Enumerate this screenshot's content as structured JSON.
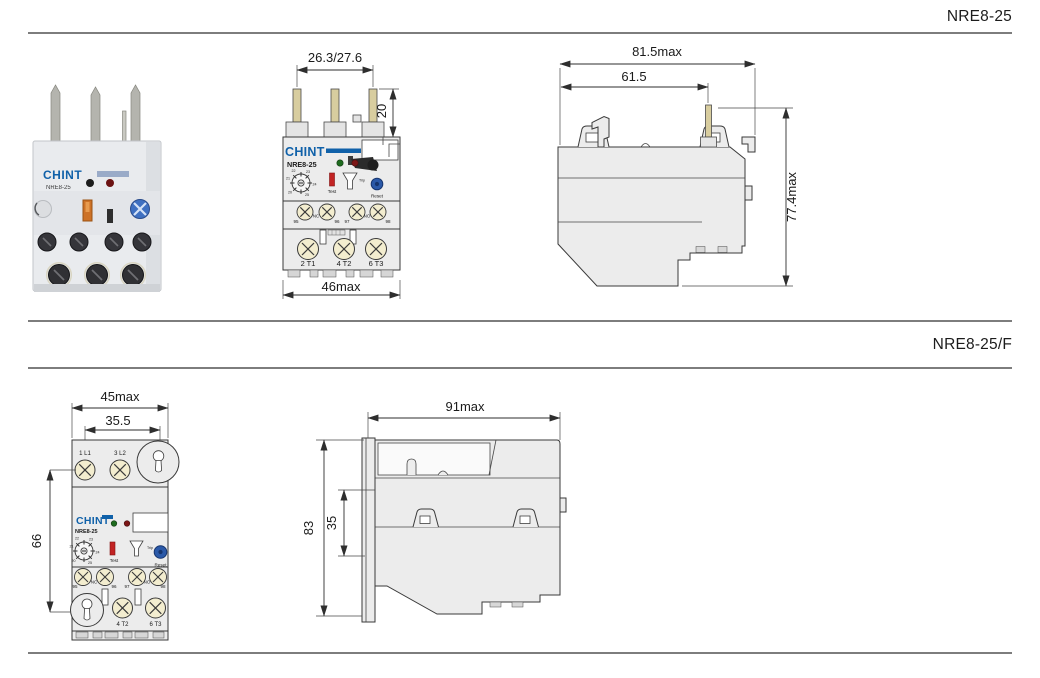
{
  "page": {
    "background": "#ffffff",
    "rule_color": "#7d7d7d"
  },
  "colors": {
    "brand_blue": "#1061a9",
    "drawing_body": "#ececec",
    "drawing_line": "#3a3a3a",
    "pin": "#d8cd9f",
    "screw": "#f3edcf",
    "green_indicator": "#1e6b1e",
    "red_indicator": "#7c1616",
    "test_red": "#c22323",
    "reset_blue": "#2b59a8"
  },
  "section_top": {
    "title": "NRE8-25",
    "photo": {
      "brand": "CHINT",
      "model": "NRE8-25"
    },
    "front": {
      "dim_pin_span": "26.3/27.6",
      "dim_pin_height": "20",
      "dim_width": "46max",
      "brand": "CHINT",
      "model": "NRE8-25",
      "dial": [
        "20",
        "21",
        "22",
        "23",
        "24",
        "25"
      ],
      "test": "Test",
      "trip": "Trip",
      "reset": "Reset",
      "aux": [
        "95",
        "NC",
        "96",
        "97",
        "NO",
        "98"
      ],
      "mains": [
        "2 T1",
        "4 T2",
        "6 T3"
      ]
    },
    "side": {
      "dim_depth_max": "81.5max",
      "dim_depth": "61.5",
      "dim_height": "77.4max"
    }
  },
  "section_bottom": {
    "title": "NRE8-25/F",
    "front": {
      "dim_width": "45max",
      "dim_span": "35.5",
      "dim_height": "66",
      "line_terminals": [
        "1 L1",
        "3 L2"
      ],
      "brand": "CHINT",
      "model": "NRE8-25",
      "dial": [
        "20",
        "21",
        "22",
        "23",
        "24",
        "25"
      ],
      "test": "Test",
      "trip": "Trip",
      "reset": "Reset",
      "aux": [
        "95",
        "NC",
        "96",
        "97",
        "NO",
        "98"
      ],
      "mains": [
        "4 T2",
        "6 T3"
      ]
    },
    "side": {
      "dim_width": "91max",
      "dim_height": "83",
      "dim_rail": "35"
    }
  }
}
